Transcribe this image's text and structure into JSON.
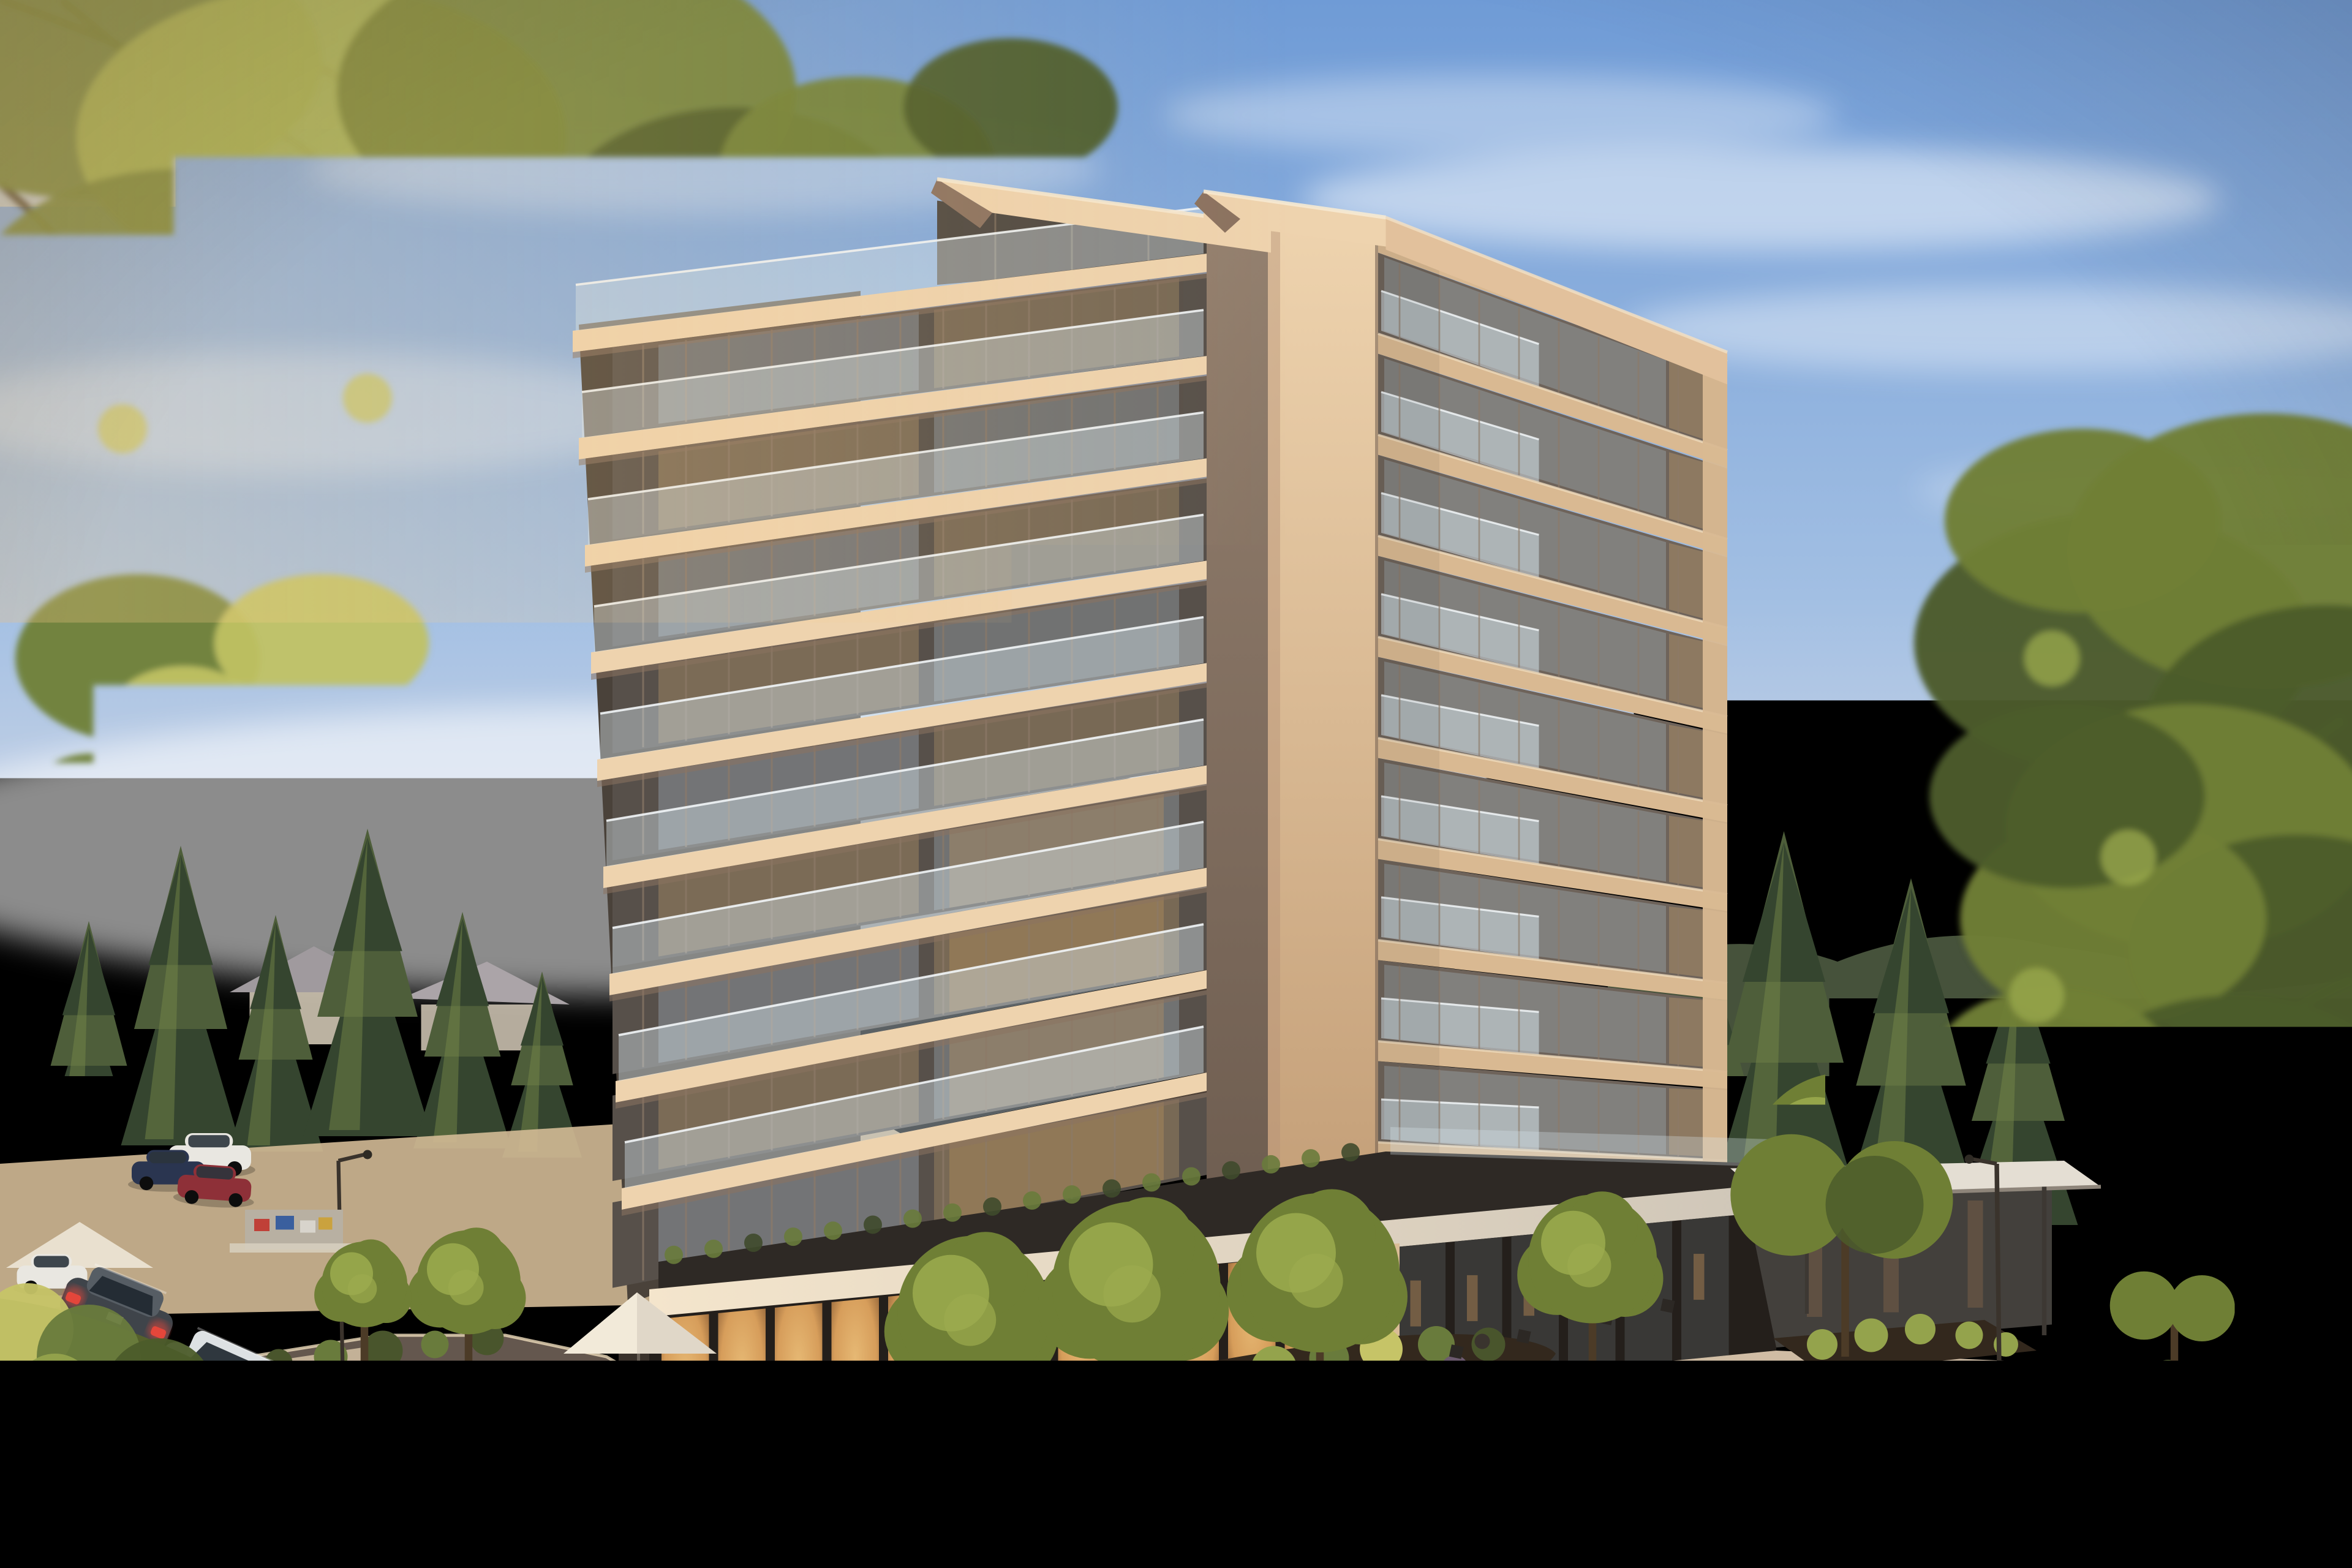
{
  "meta": {
    "title": "Modern mid-rise condominium at golden hour with snow-capped mountains",
    "type": "photorealistic architectural exterior rendering",
    "time_of_day": "golden hour, low sun from the left with lens flare",
    "setting": "tree-lined corner street in a mountain-town neighbourhood"
  },
  "palette": {
    "sky_top": "#6f9bd6",
    "sky_mid": "#a2bfe3",
    "sky_low": "#dadde7",
    "sky_horizon": "#f7ecd7",
    "cloud": "#ffffff",
    "sun_core": "#fff8e8",
    "sun_glow": "#ffe7b8",
    "ridge_left": "#c8b1bb",
    "mountain_hi": "#93889f",
    "mountain_lo": "#635d7a",
    "mountain_forest": "#49544a",
    "snow": "#ece8ea",
    "haze_pink": "#e3cdd2",
    "forest_dark": "#35452f",
    "forest_mid": "#4e5e3a",
    "forest_lit": "#7b8c4c",
    "house_roof": "#b3acae",
    "house_wall": "#d6ccbc",
    "concrete_lit": "#eed3ae",
    "concrete_mid": "#d9b992",
    "concrete_dark": "#a98a6f",
    "soffit": "#8b7260",
    "facade_dark": "#57504a",
    "facade_top": "#4e4842",
    "facade_right": "#6e635a",
    "mullion": "#8d7a68",
    "glass_sky": "#aec2d2",
    "glass_warm": "#c8a471",
    "balcony_glass": "#d9e8ef",
    "rail_bright": "#f2f6f8",
    "podium_fascia": "#efe0cb",
    "podium_dark": "#2e2925",
    "store_glow": "#e0a45e",
    "store_deep": "#754a28",
    "store_shade": "#3b3a38",
    "canopy_slab": "#e4ded3",
    "sidewalk_lit": "#e9cfa9",
    "sidewalk_cool": "#c7b6a2",
    "road_lit": "#8a7868",
    "road_dark": "#675a51",
    "curb": "#eedcbb",
    "lane_mark": "#ded6c6",
    "mulch": "#33281d",
    "shrub_dark": "#49552c",
    "shrub_mid": "#697b3c",
    "shrub_lit": "#94a34c",
    "shrub_bright": "#c6c467",
    "shrub_purple": "#6c5a6e",
    "leaf_dark": "#4c5c2a",
    "leaf_mid": "#6f7f35",
    "leaf_lit": "#9cab4e",
    "leaf_back": "#c0c264",
    "trunk": "#4c3b27",
    "lamppost": "#3a332c",
    "tent": "#f2ead9",
    "car_black": "#17181a",
    "car_silver": "#ccd0d2",
    "car_white": "#e9e7e1",
    "car_grey": "#3f444a",
    "car_blue": "#2a3550",
    "car_red": "#8e3038",
    "car_maroon": "#4a1f1f",
    "taillight": "#e8473a"
  },
  "scene": {
    "sky": {
      "clouds": 7,
      "sun_position": "upper-left with warm flare"
    },
    "mountains": {
      "left_ridge": "hazy mauve forested ridge",
      "right_range": "snow-capped peaks above dark forested slopes"
    },
    "background": {
      "conifer_trees": 11,
      "houses": [
        "large grey hipped-roof house at right",
        "smaller neighbourhood houses at left"
      ]
    },
    "building": {
      "kind": "modern mid-rise condominium",
      "towers": 2,
      "visible_floors": 10,
      "balcony_stack_floors": 9,
      "materials": [
        "warm precast concrete slabs",
        "floor-to-ceiling glazing",
        "frameless glass balustrades"
      ],
      "roof": "flat cantilevered slabs with pointed prow corners",
      "podium": {
        "storefront_bays": 19,
        "lit_interior": true,
        "entrance_canopy": true,
        "terrace_hedge": true
      }
    },
    "street": {
      "roads": 2,
      "lane_marking": "dashed centre line",
      "lampposts": 2,
      "plaza_tent": 1,
      "market_stall": 1,
      "cafe_chairs": 4
    },
    "vehicles": [
      {
        "name": "black-sedan-driving",
        "type": "sedan",
        "color_key": "car_black",
        "state": "driving away down the left lane"
      },
      {
        "name": "silver-sedan-parked",
        "type": "sedan",
        "color_key": "car_silver",
        "state": "parked on left street"
      },
      {
        "name": "grey-suv-parked",
        "type": "suv",
        "color_key": "car_grey",
        "state": "parked, taillights lit"
      },
      {
        "name": "white-hatchback-parked",
        "type": "hatchback",
        "color_key": "car_white",
        "state": "parked far left"
      },
      {
        "name": "dark-blue-car-intersection",
        "type": "sedan",
        "color_key": "car_blue",
        "state": "at intersection"
      },
      {
        "name": "white-van-intersection",
        "type": "van",
        "color_key": "car_white",
        "state": "at intersection"
      },
      {
        "name": "red-car-intersection",
        "type": "sedan",
        "color_key": "car_red",
        "state": "at intersection"
      },
      {
        "name": "silver-car-behind-foliage",
        "type": "sedan",
        "color_key": "car_silver",
        "state": "partially hidden by foreground tree"
      },
      {
        "name": "maroon-suv-bottom-right",
        "type": "suv",
        "color_key": "car_maroon",
        "state": "at curb, taillights glowing"
      },
      {
        "name": "black-car-right-edge",
        "type": "sedan",
        "color_key": "car_black",
        "state": "parked at right edge"
      }
    ],
    "foreground": {
      "top_left": "backlit deciduous branches framing the view",
      "bottom_left": "sunlit shrub slope",
      "right": "large deciduous tree framing the view",
      "street_trees": 8
    }
  }
}
